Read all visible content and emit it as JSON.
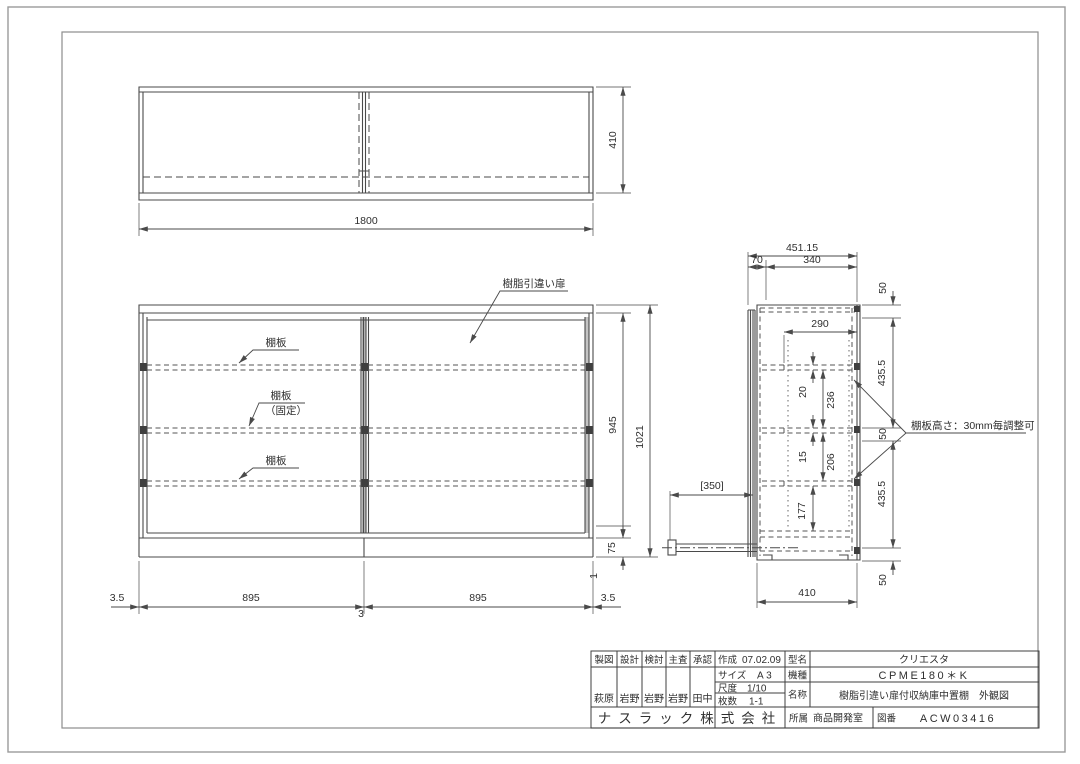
{
  "views": {
    "top": {
      "dim_width": "1800",
      "dim_depth": "410"
    },
    "front": {
      "door_label": "樹脂引違い扉",
      "shelf_top": "棚板",
      "shelf_mid": "棚板",
      "shelf_mid_sub": "（固定）",
      "shelf_bottom": "棚板",
      "dim_door_h": "945",
      "dim_total_h": "1021",
      "dim_base_h": "75",
      "dim_gap": "1",
      "dim_edge_l": "3.5",
      "dim_half_l": "895",
      "dim_half_r": "895",
      "dim_edge_r": "3.5",
      "dim_center": "3"
    },
    "side": {
      "note": "棚板高さ：30mm毎調整可",
      "dim_overall": "451.15",
      "dim_front": "70",
      "dim_top": "340",
      "dim_shelf": "290",
      "dim_counter": "[350]",
      "dim_bottom": "410",
      "dim_t1": "20",
      "dim_s1": "236",
      "dim_t2": "15",
      "dim_s2": "206",
      "dim_s3": "177",
      "dim_r1": "50",
      "dim_r2": "435.5",
      "dim_r3": "50",
      "dim_r4": "435.5",
      "dim_r5": "50"
    }
  },
  "title_block": {
    "approval_cols": [
      "製図",
      "設計",
      "検討",
      "主査",
      "承認"
    ],
    "stamps": [
      "萩原",
      "岩野",
      "岩野",
      "岩野",
      "田中"
    ],
    "created_label": "作成",
    "created_value": "07.02.09",
    "size_label": "サイズ",
    "size_value": "A3",
    "scale_label": "尺度",
    "scale_value": "1/10",
    "sheets_label": "枚数",
    "sheets_value": "1-1",
    "model_label": "型名",
    "model_value": "クリエスタ",
    "type_label": "機種",
    "type_value": "CPME180＊K",
    "name_label": "名称",
    "name_value": "樹脂引違い扉付収納庫中置棚　外観図",
    "company": "ナスラック株式会社",
    "dept_label": "所属",
    "dept_value": "商品開発室",
    "drawing_no_label": "図番",
    "drawing_no_value": "ACW03416"
  }
}
